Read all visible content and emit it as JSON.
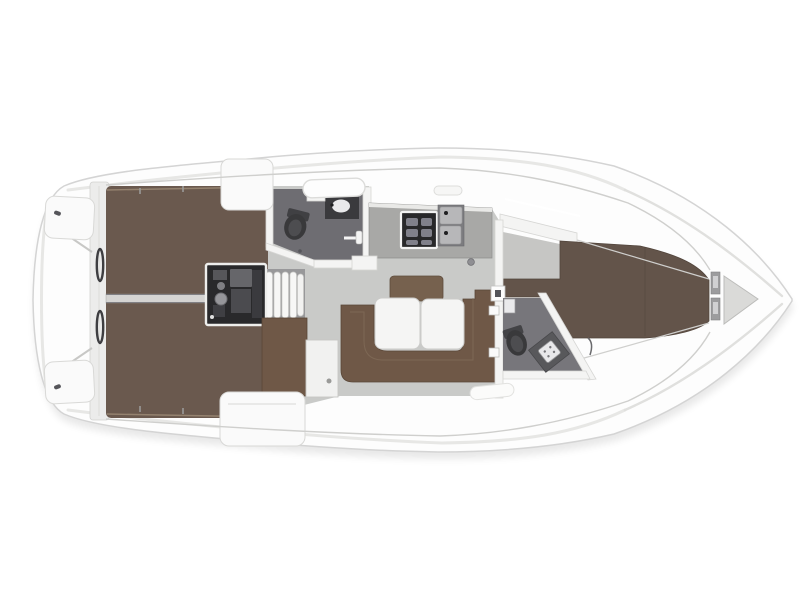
{
  "diagram": {
    "kind": "sailboat-interior-floor-plan",
    "orientation": "bow-right"
  },
  "colors": {
    "background": "#ffffff",
    "hull": "#fdfdfd",
    "hull_outline": "#d4d4d4",
    "deck_line": "#d0d0ce",
    "shadow_gray": "#000000",
    "aft_berth_brown": "#6a594e",
    "berth_divider": "#d5d4d2",
    "saloon_floor_gray": "#c9cac8",
    "fwd_floor_gray": "#c6c6c4",
    "sofa_brown": "#6f5847",
    "backrest_brown": "#76614e",
    "table_white": "#f5f5f4",
    "nav_table_white": "#f1f1f0",
    "galley_counter_gray": "#a8a8a6",
    "stove_dark": "#28282a",
    "sink_well_gray": "#7c7c7f",
    "sink_steel": "#b7b7b9",
    "aft_bath_floor": "#6e6d72",
    "fwd_bath_floor": "#77767b",
    "fixture_dark": "#39393b",
    "shower_tray_gray": "#58585b",
    "vberth_brown": "#63544a",
    "engine_dark": "#29292b",
    "wall_white": "#f4f4f3",
    "bench_white": "#fafafa",
    "anchor_locker_gray": "#dadad8",
    "bow_panel_gray": "#9c9c9e"
  }
}
